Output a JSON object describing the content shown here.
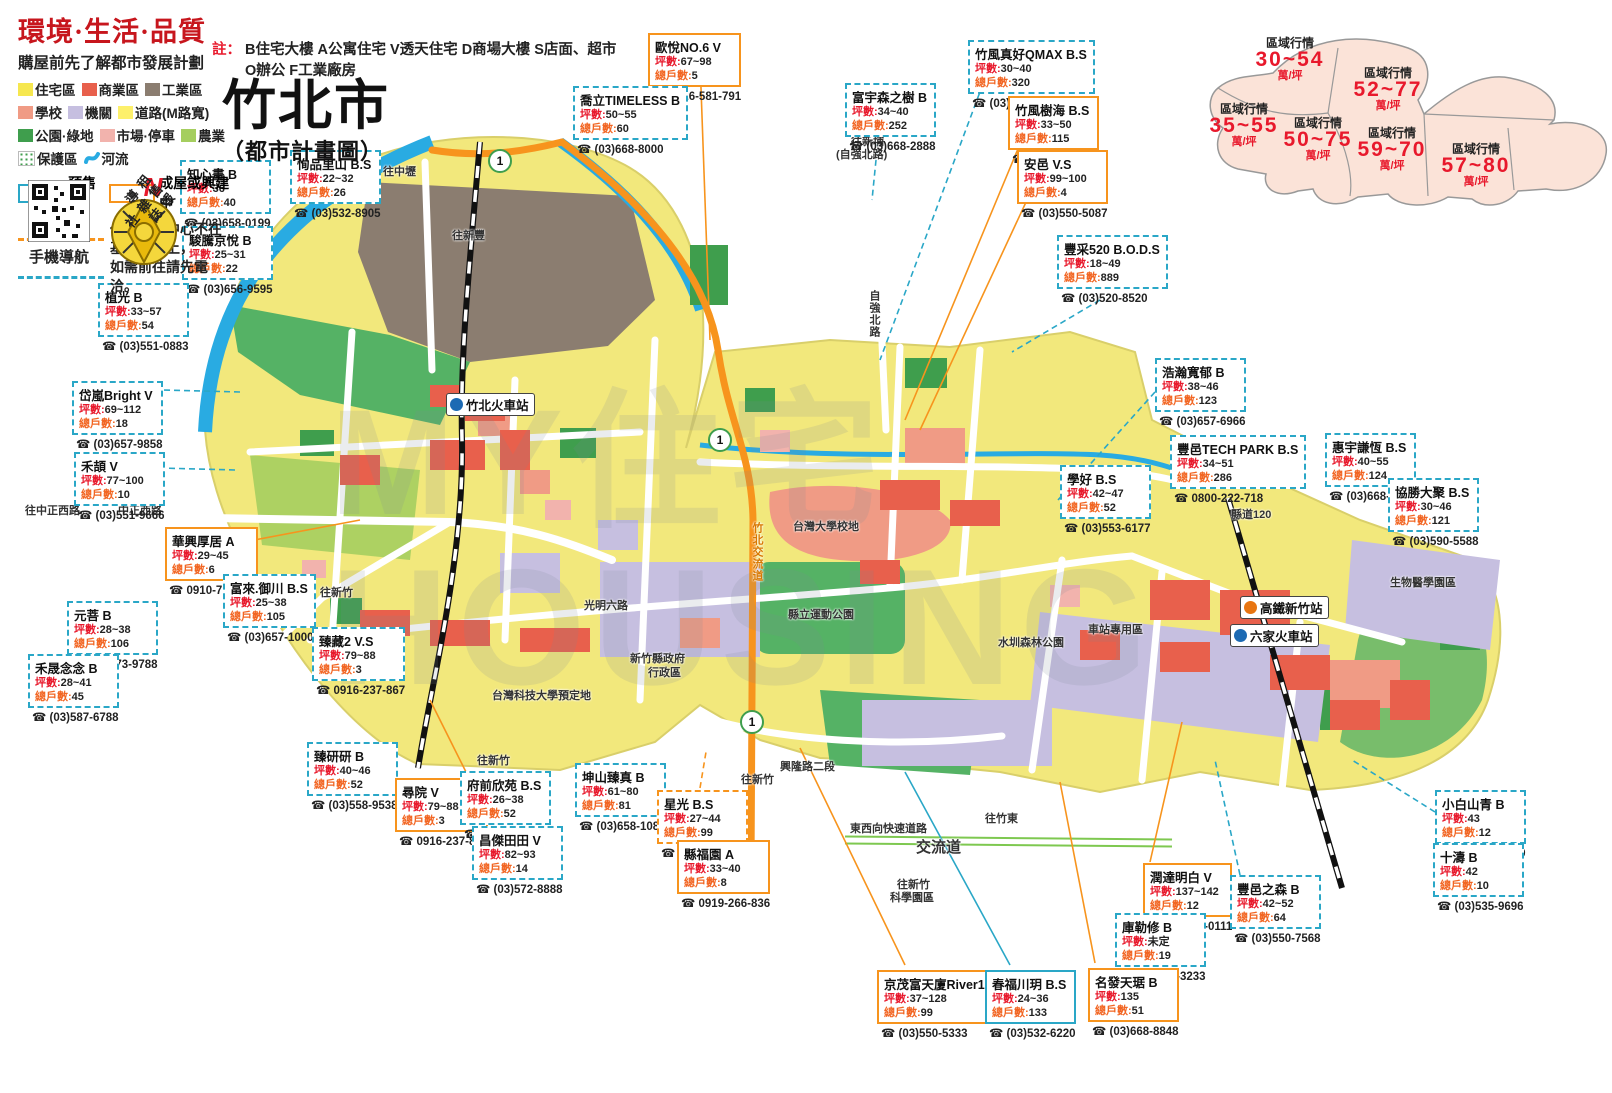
{
  "header": {
    "slogan": "環境·生活·品質",
    "subtitle": "購屋前先了解都市發展計劃",
    "note_label": "註：",
    "note_line1": "B住宅大樓 A公寓住宅 V透天住宅 D商場大樓 S店面、超市",
    "note_line2": "O辦公 F工業廠房",
    "title": "竹北市",
    "title_sub": "（都市計畫圖）",
    "qr_caption": "手機導航",
    "compass_n": "N",
    "compass_text": "租售報導雜誌社"
  },
  "legend": {
    "items": [
      {
        "label": "住宅區",
        "color": "#f6e74f"
      },
      {
        "label": "商業區",
        "color": "#e8604c"
      },
      {
        "label": "工業區",
        "color": "#8b7d70"
      },
      {
        "label": "學校",
        "color": "#f09b85"
      },
      {
        "label": "機關",
        "color": "#c6bfe0"
      },
      {
        "label": "道路(M路寬)",
        "color": "#fdf06b"
      },
      {
        "label": "公園·綠地",
        "color": "#3f9e4d"
      },
      {
        "label": "市場·停車",
        "color": "#f2b3ad"
      },
      {
        "label": "農業",
        "color": "#a5ce5f"
      },
      {
        "label": "保護區",
        "swatch": "dots"
      },
      {
        "label": "河流",
        "swatch": "river"
      }
    ],
    "presale_label": "預售屋",
    "built_label": "成屋或興建中",
    "notice1": "代表接待中心不在基地位置上，",
    "notice2": "如需前往請先電洽。"
  },
  "price_inset": {
    "label": "區域行情",
    "unit": "萬/坪",
    "zones": [
      {
        "range": "30~54",
        "x": 112,
        "y": 42
      },
      {
        "range": "52~77",
        "x": 210,
        "y": 72
      },
      {
        "range": "35~55",
        "x": 66,
        "y": 108
      },
      {
        "range": "50~75",
        "x": 140,
        "y": 122
      },
      {
        "range": "59~70",
        "x": 214,
        "y": 132
      },
      {
        "range": "57~80",
        "x": 298,
        "y": 148
      }
    ]
  },
  "callout_labels": {
    "ping": "坪數",
    "units": "總戶數"
  },
  "listings": [
    {
      "name": "知心畫 B",
      "ping": "36",
      "units": "40",
      "phone": "(03)658-0199",
      "x": 180,
      "y": 160,
      "style": "cyan-dashed"
    },
    {
      "name": "恂品里山 B.S",
      "ping": "22~32",
      "units": "26",
      "phone": "(03)532-8905",
      "x": 290,
      "y": 150,
      "style": "cyan-dashed"
    },
    {
      "name": "駿騰京悅 B",
      "ping": "25~31",
      "units": "22",
      "phone": "(03)656-9595",
      "x": 182,
      "y": 226,
      "style": "cyan-dashed"
    },
    {
      "name": "植光 B",
      "ping": "33~57",
      "units": "54",
      "phone": "(03)551-0883",
      "x": 98,
      "y": 283,
      "style": "cyan-dashed"
    },
    {
      "name": "岱嵐Bright V",
      "ping": "69~112",
      "units": "18",
      "phone": "(03)657-9858",
      "x": 72,
      "y": 381,
      "style": "cyan-dashed"
    },
    {
      "name": "禾頡 V",
      "ping": "77~100",
      "units": "10",
      "phone": "(03)551-9666",
      "x": 74,
      "y": 452,
      "style": "cyan-dashed"
    },
    {
      "name": "華興厚居 A",
      "ping": "29~45",
      "units": "6",
      "phone": "0910-713-606",
      "x": 165,
      "y": 527,
      "style": "orange-solid"
    },
    {
      "name": "富來.御川 B.S",
      "ping": "25~38",
      "units": "105",
      "phone": "(03)657-1000",
      "x": 223,
      "y": 574,
      "style": "cyan-dashed"
    },
    {
      "name": "元菩 B",
      "ping": "28~38",
      "units": "106",
      "phone": "(03)573-9788",
      "x": 67,
      "y": 601,
      "style": "cyan-dashed"
    },
    {
      "name": "禾晟念念 B",
      "ping": "28~41",
      "units": "45",
      "phone": "(03)587-6788",
      "x": 28,
      "y": 654,
      "style": "cyan-dashed"
    },
    {
      "name": "臻藏2 V.S",
      "ping": "79~88",
      "units": "3",
      "phone": "0916-237-867",
      "x": 312,
      "y": 627,
      "style": "cyan-dashed"
    },
    {
      "name": "臻研研 B",
      "ping": "40~46",
      "units": "52",
      "phone": "(03)558-9538",
      "x": 307,
      "y": 742,
      "style": "cyan-dashed"
    },
    {
      "name": "尋院 V",
      "ping": "79~88",
      "units": "3",
      "phone": "0916-237-867",
      "x": 395,
      "y": 778,
      "style": "orange-solid"
    },
    {
      "name": "府前欣苑 B.S",
      "ping": "26~38",
      "units": "52",
      "phone": "(03)657-3456",
      "x": 460,
      "y": 771,
      "style": "cyan-dashed"
    },
    {
      "name": "昌傑田田 V",
      "ping": "82~93",
      "units": "14",
      "phone": "(03)572-8888",
      "x": 472,
      "y": 826,
      "style": "cyan-dashed"
    },
    {
      "name": "坤山臻真 B",
      "ping": "61~80",
      "units": "81",
      "phone": "(03)658-1088",
      "x": 575,
      "y": 763,
      "style": "cyan-dashed"
    },
    {
      "name": "星光 B.S",
      "ping": "27~44",
      "units": "99",
      "phone": "(03)657-2345",
      "x": 657,
      "y": 790,
      "style": "orange-dashed"
    },
    {
      "name": "縣福園 A",
      "ping": "33~40",
      "units": "8",
      "phone": "0919-266-836",
      "x": 677,
      "y": 840,
      "style": "orange-solid"
    },
    {
      "name": "歐悅NO.6 V",
      "ping": "67~98",
      "units": "5",
      "phone": "0926-581-791",
      "x": 648,
      "y": 33,
      "style": "orange-solid"
    },
    {
      "name": "喬立TIMELESS B",
      "ping": "50~55",
      "units": "60",
      "phone": "(03)668-8000",
      "x": 573,
      "y": 86,
      "style": "cyan-dashed"
    },
    {
      "name": "富宇森之樹 B",
      "ping": "34~40",
      "units": "252",
      "phone": "(03)668-2888",
      "x": 845,
      "y": 83,
      "style": "cyan-dashed"
    },
    {
      "name": "竹風真好QMAX B.S",
      "ping": "30~40",
      "units": "320",
      "phone": "(03)658-8888",
      "x": 968,
      "y": 40,
      "style": "cyan-dashed"
    },
    {
      "name": "竹風樹海 B.S",
      "ping": "33~50",
      "units": "115",
      "phone": "(03)658-8888",
      "x": 1008,
      "y": 96,
      "style": "orange-solid"
    },
    {
      "name": "安邑 V.S",
      "ping": "99~100",
      "units": "4",
      "phone": "(03)550-5087",
      "x": 1017,
      "y": 150,
      "style": "orange-solid"
    },
    {
      "name": "豐采520 B.O.D.S",
      "ping": "18~49",
      "units": "889",
      "phone": "(03)520-8520",
      "x": 1057,
      "y": 235,
      "style": "cyan-dashed"
    },
    {
      "name": "浩瀚寬郁 B",
      "ping": "38~46",
      "units": "123",
      "phone": "(03)657-6966",
      "x": 1155,
      "y": 358,
      "style": "cyan-dashed"
    },
    {
      "name": "豐邑TECH PARK B.S",
      "ping": "34~51",
      "units": "286",
      "phone": "0800-222-718",
      "x": 1170,
      "y": 435,
      "style": "cyan-dashed"
    },
    {
      "name": "惠宇謙恆 B.S",
      "ping": "40~55",
      "units": "124",
      "phone": "(03)668-6066",
      "x": 1325,
      "y": 433,
      "style": "cyan-dashed"
    },
    {
      "name": "學好 B.S",
      "ping": "42~47",
      "units": "52",
      "phone": "(03)553-6177",
      "x": 1060,
      "y": 465,
      "style": "cyan-dashed"
    },
    {
      "name": "協勝大聚 B.S",
      "ping": "30~46",
      "units": "121",
      "phone": "(03)590-5588",
      "x": 1388,
      "y": 478,
      "style": "cyan-dashed"
    },
    {
      "name": "小白山青 B",
      "ping": "43",
      "units": "12",
      "phone": "(03)658-0999",
      "x": 1435,
      "y": 790,
      "style": "cyan-dashed"
    },
    {
      "name": "十濤 B",
      "ping": "42",
      "units": "10",
      "phone": "(03)535-9696",
      "x": 1433,
      "y": 843,
      "style": "cyan-dashed"
    },
    {
      "name": "潤達明白 V",
      "ping": "137~142",
      "units": "12",
      "phone": "(03)658-0111",
      "x": 1143,
      "y": 863,
      "style": "orange-solid"
    },
    {
      "name": "豐邑之森 B",
      "ping": "42~52",
      "units": "64",
      "phone": "(03)550-7568",
      "x": 1230,
      "y": 875,
      "style": "cyan-dashed"
    },
    {
      "name": "庫勒修 B",
      "ping": "未定",
      "units": "19",
      "phone": "(03)525-3233",
      "x": 1115,
      "y": 913,
      "style": "cyan-dashed"
    },
    {
      "name": "名發天琚 B",
      "ping": "135",
      "units": "51",
      "phone": "(03)668-8848",
      "x": 1088,
      "y": 968,
      "style": "orange-solid"
    },
    {
      "name": "京茂富天廈River1 B.O.S",
      "ping": "37~128",
      "units": "99",
      "phone": "(03)550-5333",
      "x": 877,
      "y": 970,
      "style": "orange-solid"
    },
    {
      "name": "春福川玥 B.S",
      "ping": "24~36",
      "units": "133",
      "phone": "(03)532-6220",
      "x": 985,
      "y": 970,
      "style": "cyan-solid"
    }
  ],
  "map_labels": [
    {
      "text": "往中壢",
      "x": 383,
      "y": 163
    },
    {
      "text": "往新豐",
      "x": 452,
      "y": 227
    },
    {
      "text": "往新埔",
      "x": 851,
      "y": 133
    },
    {
      "text": "(自強北路)",
      "x": 836,
      "y": 146
    },
    {
      "text": "往中正西路",
      "x": 25,
      "y": 502
    },
    {
      "text": "中正西路",
      "x": 118,
      "y": 502
    },
    {
      "text": "往新竹",
      "x": 320,
      "y": 584
    },
    {
      "text": "往新竹",
      "x": 477,
      "y": 752
    },
    {
      "text": "往新竹",
      "x": 741,
      "y": 771
    },
    {
      "text": "新竹縣政府",
      "x": 630,
      "y": 650
    },
    {
      "text": "行政區",
      "x": 648,
      "y": 664
    },
    {
      "text": "台灣科技大學預定地",
      "x": 492,
      "y": 687
    },
    {
      "text": "台灣大學校地",
      "x": 793,
      "y": 518
    },
    {
      "text": "縣立運動公園",
      "x": 788,
      "y": 606
    },
    {
      "text": "水圳森林公園",
      "x": 998,
      "y": 634
    },
    {
      "text": "車站專用區",
      "x": 1088,
      "y": 621
    },
    {
      "text": "生物醫學園區",
      "x": 1390,
      "y": 574
    },
    {
      "text": "興隆路二段",
      "x": 780,
      "y": 758
    },
    {
      "text": "東西向快速道路",
      "x": 850,
      "y": 820,
      "cls": ""
    },
    {
      "text": "交流道",
      "x": 916,
      "y": 836,
      "cls": "big"
    },
    {
      "text": "往竹東",
      "x": 985,
      "y": 810
    },
    {
      "text": "往新竹",
      "x": 897,
      "y": 876
    },
    {
      "text": "科學園區",
      "x": 890,
      "y": 889
    },
    {
      "text": "縣道120",
      "x": 1231,
      "y": 506
    },
    {
      "text": "竹北交流道",
      "x": 749,
      "y": 522,
      "cls": "vert orange"
    },
    {
      "text": "光明六路",
      "x": 584,
      "y": 597
    },
    {
      "text": "自強北路",
      "x": 866,
      "y": 290,
      "cls": "vert"
    }
  ],
  "stations": [
    {
      "name": "竹北火車站",
      "x": 446,
      "y": 393,
      "type": "rail"
    },
    {
      "name": "高鐵新竹站",
      "x": 1240,
      "y": 596,
      "type": "hsr"
    },
    {
      "name": "六家火車站",
      "x": 1230,
      "y": 624,
      "type": "rail"
    }
  ],
  "route_shields": [
    {
      "label": "1",
      "x": 488,
      "y": 149
    },
    {
      "label": "1",
      "x": 708,
      "y": 428
    },
    {
      "label": "1",
      "x": 740,
      "y": 710
    }
  ],
  "watermark": {
    "line1": "MY住宅",
    "line2": "HOUSING"
  },
  "colors": {
    "residential": "#f2e87c",
    "commercial": "#e8604c",
    "industrial": "#8b7d70",
    "school": "#f09b85",
    "agency": "#c6bfe0",
    "park": "#3f9e4d",
    "market": "#f2b3ad",
    "farm": "#a5ce5f",
    "river": "#29abe2",
    "highway": "#f7941d",
    "presale_border": "#2aa7c7",
    "built_border": "#f7941d",
    "red_text": "#e8192c"
  }
}
